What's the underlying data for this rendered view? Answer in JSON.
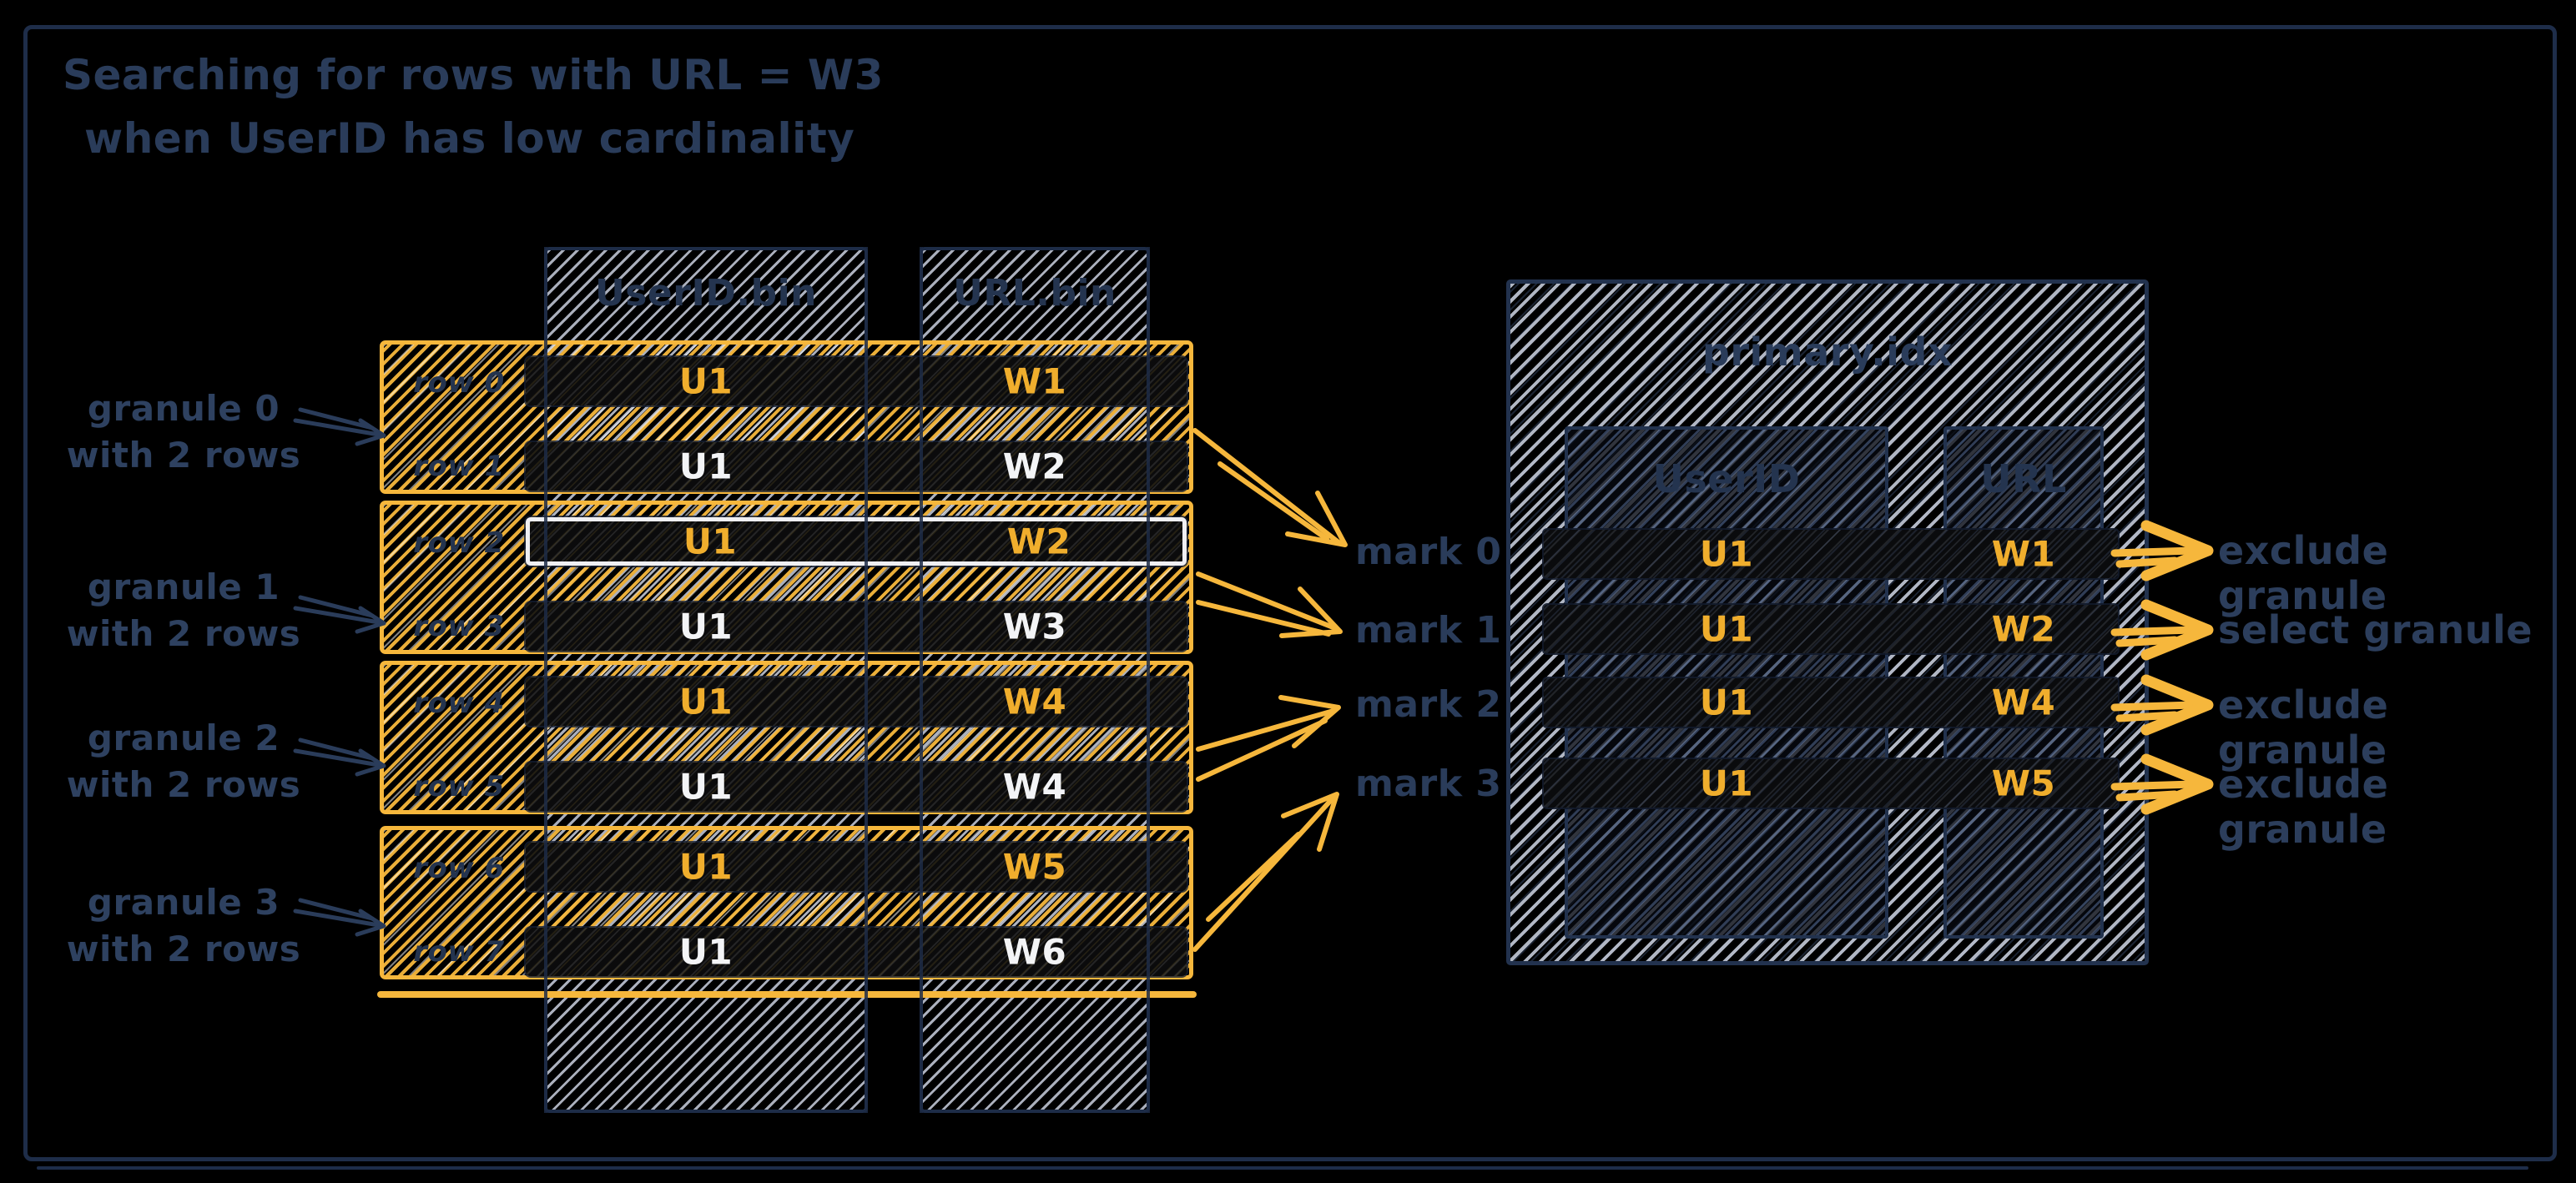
{
  "title": {
    "line1": "Searching for rows with URL = W3",
    "line2": "when UserID has low cardinality"
  },
  "left_table": {
    "column_headers": {
      "userid": "UserID.bin",
      "url": "URL.bin"
    },
    "granules": [
      {
        "label": [
          "granule 0",
          "with 2 rows"
        ],
        "rows": [
          {
            "label": "row 0",
            "userid": "U1",
            "url": "W1"
          },
          {
            "label": "row 1",
            "userid": "U1",
            "url": "W2"
          }
        ]
      },
      {
        "label": [
          "granule 1",
          "with 2 rows"
        ],
        "rows": [
          {
            "label": "row 2",
            "userid": "U1",
            "url": "W2"
          },
          {
            "label": "row 3",
            "userid": "U1",
            "url": "W3"
          }
        ]
      },
      {
        "label": [
          "granule 2",
          "with 2 rows"
        ],
        "rows": [
          {
            "label": "row 4",
            "userid": "U1",
            "url": "W4"
          },
          {
            "label": "row 5",
            "userid": "U1",
            "url": "W4"
          }
        ]
      },
      {
        "label": [
          "granule 3",
          "with 2 rows"
        ],
        "rows": [
          {
            "label": "row 6",
            "userid": "U1",
            "url": "W5"
          },
          {
            "label": "row 7",
            "userid": "U1",
            "url": "W6"
          }
        ]
      }
    ]
  },
  "marks": [
    {
      "label": "mark 0"
    },
    {
      "label": "mark 1"
    },
    {
      "label": "mark 2"
    },
    {
      "label": "mark 3"
    }
  ],
  "index_table": {
    "title": "primary.idx",
    "column_headers": {
      "userid": "UserID",
      "url": "URL"
    },
    "rows": [
      {
        "userid": "U1",
        "url": "W1"
      },
      {
        "userid": "U1",
        "url": "W2"
      },
      {
        "userid": "U1",
        "url": "W4"
      },
      {
        "userid": "U1",
        "url": "W5"
      }
    ]
  },
  "outcomes": [
    {
      "label": "exclude granule"
    },
    {
      "label": "select granule"
    },
    {
      "label": "exclude granule"
    },
    {
      "label": "exclude granule"
    }
  ],
  "colors": {
    "accent_orange": "#F6B73C",
    "accent_text": "#F0AE2D",
    "navy_text": "#2A3C5A",
    "row_text_white": "#F3F4F6",
    "hatch_gray": "#C9CFDE",
    "background": "#000000"
  }
}
